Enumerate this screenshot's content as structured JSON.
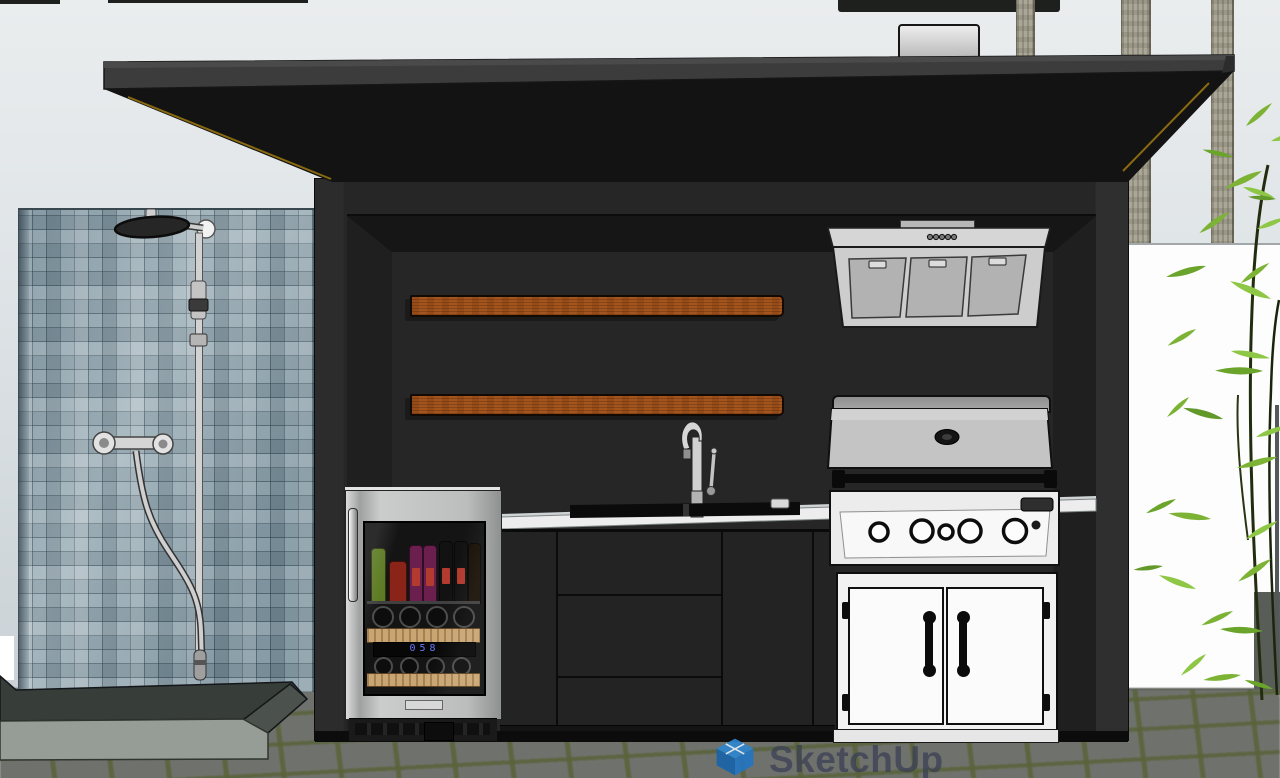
{
  "app": {
    "watermark": {
      "label": "SketchUp"
    }
  },
  "viewport": {
    "width_px": 1280,
    "height_px": 778,
    "scene_description": "Front elevation of a black flat-roof outdoor kitchen pavilion: mosaic-tiled shower wall with chrome shower set at left, beverage cooler, wood floating shelves, sink with gooseneck faucet, gas grill with range hood and white access doors; palm trunks, white boundary wall and bamboo behind, gray pavers with olive joints in front"
  },
  "fridge": {
    "display_value": "058"
  },
  "colors": {
    "sky": "#dfe4e7",
    "roof_black": "#141414",
    "roof_trim_gold": "#9c7a14",
    "pavilion_frame": "#262626",
    "tile_blue_gray": "#96aab3",
    "shelf_wood": "#a4551d",
    "stainless_steel": "#c6c6c6",
    "counter_white": "#ecedec",
    "appliance_white": "#f2f2f2",
    "cabinet_charcoal": "#232323",
    "paver_gray": "#6f726c",
    "joint_olive": "#5c6540",
    "bamboo_green": "#7cb82f",
    "watermark_blue": "#2e86d3",
    "watermark_text": "#3a4056",
    "led_blue": "#6a79ff"
  },
  "counts": {
    "floating_shelves": 2,
    "grill_knobs": 5,
    "hood_filters": 3,
    "hood_buttons": 5,
    "door_panels": 2,
    "shower_valve_knobs": 2,
    "palm_trunks": 3
  }
}
